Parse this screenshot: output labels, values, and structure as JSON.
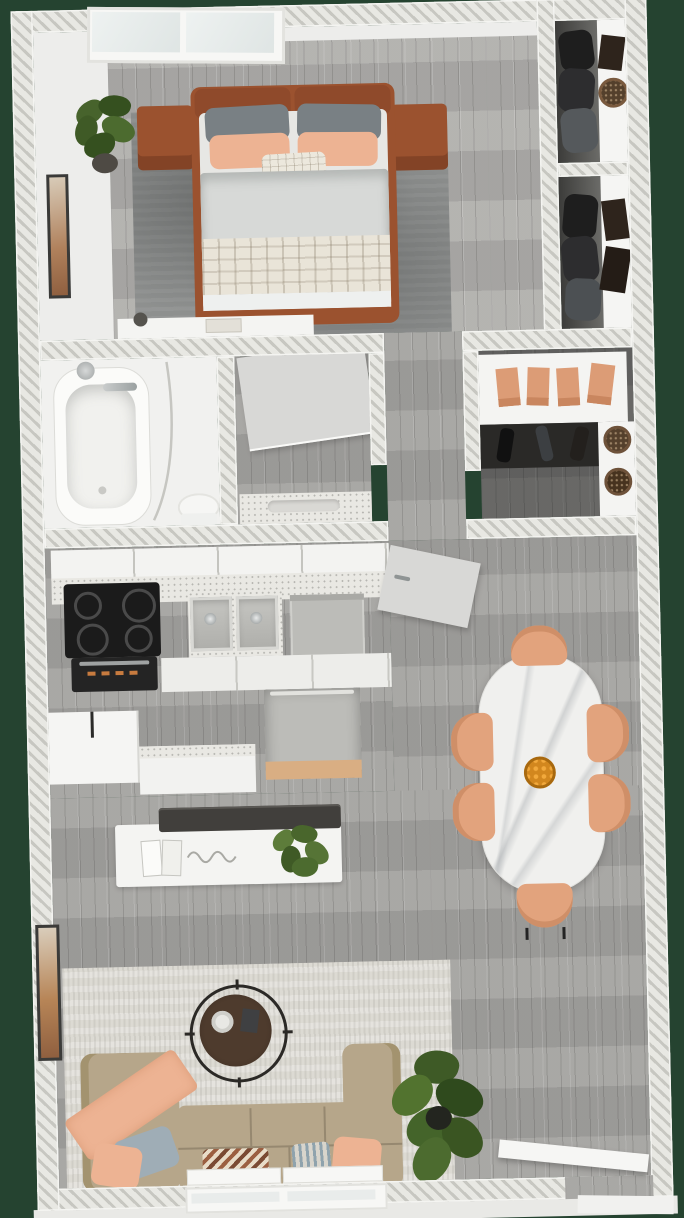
{
  "scene": {
    "description": "3D bird's-eye rendering of a one-bedroom apartment floor plan with furniture",
    "background_color": "#254330",
    "wall_style": "diagonal-hatched cut walls"
  },
  "palette": {
    "bg": "#254330",
    "wallHatchLight": "#e8e8e3",
    "wallHatchDark": "#c7c7c1",
    "floorWood": "#a4a3a0",
    "floorLightBase": "#ededeb",
    "rugBedroom": "#8e908f",
    "rugLiving": "#dcdad3",
    "bedFrame": "#9b522f",
    "pillowGray": "#798084",
    "peach": "#edb393",
    "peachDeep": "#dc9c76",
    "duvet": "#d7d9d7",
    "plaid": "#e9e4d8",
    "sofa": "#b6a68a",
    "pillowBlue": "#9fadb6",
    "tableMarble": "#f0f0ee",
    "chairPeach": "#e2a37d",
    "coffeeTableWood": "#4e3b2d",
    "counter": "#e9e8e3",
    "applianceSteel": "#bcbcb8",
    "stove": "#1b1b1b",
    "plantGreen": "#47632c",
    "plantDark": "#35501f",
    "basketBrown": "#54402c",
    "boxDark": "#2e241c",
    "flowerOrange": "#d2871e",
    "woodTan": "#d9ae83",
    "doorGray": "#d8d8d6",
    "white": "#f5f5f3"
  },
  "rooms": [
    {
      "id": "bedroom",
      "label": "Bedroom",
      "furniture": [
        "double-window",
        "potted-plant",
        "wall-art",
        "double-bed",
        "headboard",
        "gray-pillows",
        "peach-pillows",
        "plaid-accent-pillow",
        "duvet",
        "plaid-blanket",
        "nightstand-left",
        "nightstand-right",
        "area-rug",
        "foot-console",
        "vase"
      ]
    },
    {
      "id": "closet-top",
      "label": "Closet (top right)",
      "furniture": [
        "white-shelf",
        "storage-box",
        "round-woven-basket",
        "hanging-clothes"
      ]
    },
    {
      "id": "closet-lower",
      "label": "Closet (second)",
      "furniture": [
        "white-shelf",
        "storage-box-upper",
        "storage-box-lower",
        "hanging-clothes"
      ]
    },
    {
      "id": "bathroom",
      "label": "Bathroom",
      "furniture": [
        "bathtub",
        "shower-head",
        "tub-faucet",
        "shower-curtain-rod",
        "toilet"
      ]
    },
    {
      "id": "vanity-room",
      "label": "Vanity / WC",
      "furniture": [
        "open-door",
        "vanity-counter",
        "integrated-sink"
      ]
    },
    {
      "id": "hallway",
      "label": "Hallway",
      "furniture": []
    },
    {
      "id": "walk-in-closet",
      "label": "Walk-in closet",
      "furniture": [
        "top-shelf",
        "peach-storage-boxes-x4",
        "hanging-clothes",
        "side-shelf",
        "round-basket-1",
        "round-basket-2"
      ]
    },
    {
      "id": "kitchen",
      "label": "Kitchen",
      "furniture": [
        "upper-cabinets",
        "countertop",
        "cooktop",
        "oven",
        "double-sink",
        "dishwasher",
        "base-cabinets",
        "cabinet-box",
        "counter-extension",
        "open-appliance-wood-tray"
      ]
    },
    {
      "id": "dining",
      "label": "Dining area",
      "furniture": [
        "open-entry-door",
        "oval-marble-table",
        "orange-flower-centerpiece",
        "dining-chair-top",
        "dining-chair-bottom",
        "dining-chair-left-1",
        "dining-chair-left-2",
        "dining-chair-right-1",
        "dining-chair-right-2"
      ]
    },
    {
      "id": "living",
      "label": "Living room",
      "furniture": [
        "kitchen-island",
        "dark-bar-counter",
        "books",
        "island-plant",
        "wall-art",
        "area-rug",
        "round-coffee-table",
        "bowl",
        "book",
        "l-shaped-sofa",
        "peach-throw-blanket",
        "pillow-blue",
        "pillow-peach-1",
        "zigzag-pillow",
        "striped-pillow",
        "pillow-peach-2",
        "large-floor-plant",
        "bottom-window",
        "entry-door-open"
      ]
    }
  ]
}
